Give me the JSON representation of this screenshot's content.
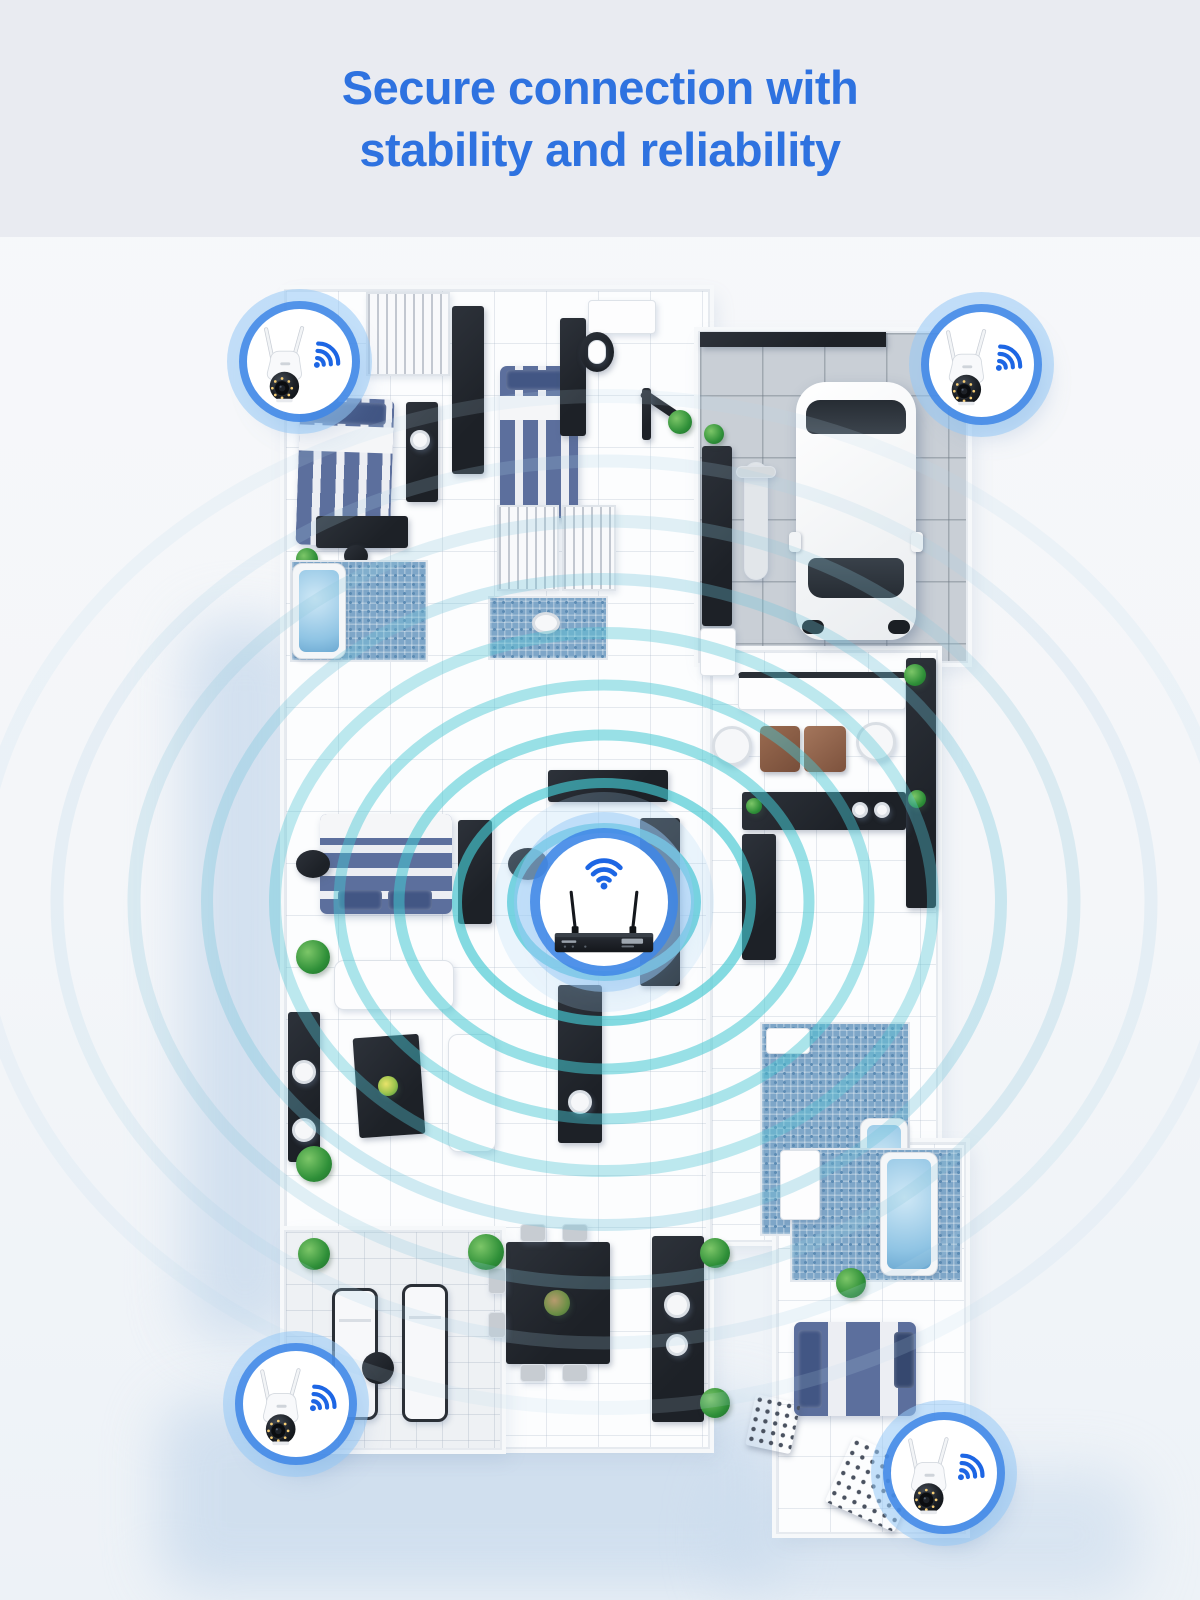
{
  "header": {
    "title_line1": "Secure connection with",
    "title_line2": "stability and reliability"
  },
  "palette": {
    "title_blue": "#2E72E0",
    "header_background": "#E9EBF1",
    "page_background": "#F7F8FA",
    "wifi_blue": "#1D66E4",
    "badge_ring_blue": "#3E86E6",
    "badge_halo_blue": "#9ECBF5",
    "signal_wave_teal": "#49C9D4",
    "furniture_dark": "#23272E",
    "bed_blue": "#5C6F9D",
    "mosaic_tile_blue": "#7EA6C8",
    "plant_green": "#2E8F38",
    "garage_floor_gray": "#C9CFD6",
    "car_body_white": "#F6F7F9"
  },
  "scene": {
    "devices": {
      "hub": {
        "name": "wireless-nvr-hub",
        "icon": "wifi-icon",
        "antennas": 2
      },
      "cameras": [
        {
          "name": "ptz-camera",
          "location": "top-left",
          "icon": "wifi-icon"
        },
        {
          "name": "ptz-camera",
          "location": "top-right",
          "icon": "wifi-icon"
        },
        {
          "name": "ptz-camera",
          "location": "bottom-left",
          "icon": "wifi-icon"
        },
        {
          "name": "ptz-camera",
          "location": "bottom-right",
          "icon": "wifi-icon"
        }
      ]
    }
  }
}
